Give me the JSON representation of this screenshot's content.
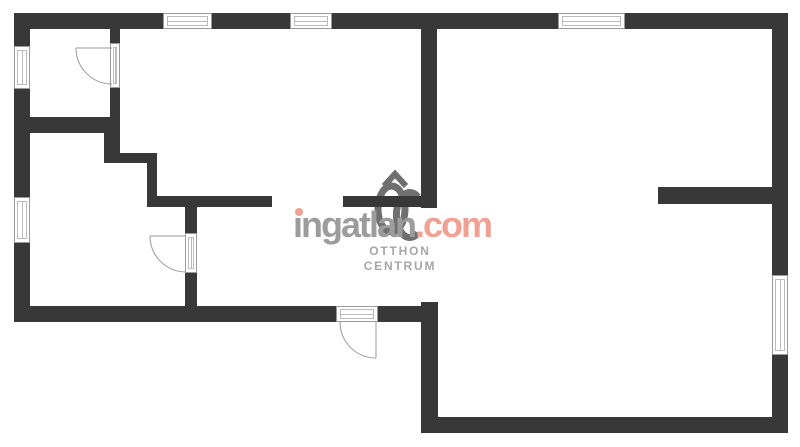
{
  "page": {
    "background": "#ffffff"
  },
  "watermark": {
    "brand": {
      "first_letter": "i",
      "rest": "ngatlan",
      "tld": ".com"
    },
    "logo_text_line1": "OTTHON",
    "logo_text_line2": "CENTRUM",
    "colors": {
      "brand_gray": "#9c9c9c",
      "accent_salmon": "#f0a292",
      "logo_gray": "#6f6f6f",
      "logo_text_gray": "#a6a6a6"
    }
  },
  "floorplan": {
    "canvas": {
      "width": 800,
      "height": 447
    },
    "wall_color": "#383838",
    "symbol_stroke": "#9a9a9a",
    "walls": [
      {
        "name": "wall-exterior-top",
        "x": 14,
        "y": 13,
        "w": 774,
        "h": 16
      },
      {
        "name": "wall-exterior-left",
        "x": 14,
        "y": 13,
        "w": 16,
        "h": 309
      },
      {
        "name": "wall-exterior-right",
        "x": 772,
        "y": 13,
        "w": 16,
        "h": 420
      },
      {
        "name": "wall-bottom-left-section",
        "x": 14,
        "y": 306,
        "w": 424,
        "h": 16
      },
      {
        "name": "wall-bottom-right-section",
        "x": 421,
        "y": 417,
        "w": 367,
        "h": 16
      },
      {
        "name": "wall-central-upper",
        "x": 421,
        "y": 29,
        "w": 16,
        "h": 179
      },
      {
        "name": "wall-central-lower",
        "x": 421,
        "y": 302,
        "w": 17,
        "h": 131
      },
      {
        "name": "wall-room1-right",
        "x": 110,
        "y": 29,
        "w": 10,
        "h": 104
      },
      {
        "name": "wall-room1-bottom",
        "x": 14,
        "y": 117,
        "w": 106,
        "h": 16
      },
      {
        "name": "wall-step-vertical-1",
        "x": 104,
        "y": 133,
        "w": 16,
        "h": 30
      },
      {
        "name": "wall-step-horizontal",
        "x": 104,
        "y": 153,
        "w": 53,
        "h": 10
      },
      {
        "name": "wall-step-vertical-2",
        "x": 147,
        "y": 153,
        "w": 10,
        "h": 54
      },
      {
        "name": "wall-hall-top-left",
        "x": 147,
        "y": 196,
        "w": 125,
        "h": 11
      },
      {
        "name": "wall-hall-top-right",
        "x": 343,
        "y": 196,
        "w": 94,
        "h": 11
      },
      {
        "name": "wall-hall-left",
        "x": 185,
        "y": 207,
        "w": 12,
        "h": 99
      },
      {
        "name": "wall-right-room-stub",
        "x": 658,
        "y": 187,
        "w": 130,
        "h": 17
      }
    ],
    "windows": [
      {
        "name": "window-top-1",
        "x": 163,
        "y": 13,
        "w": 49,
        "h": 16,
        "orientation": "h"
      },
      {
        "name": "window-top-2",
        "x": 290,
        "y": 13,
        "w": 42,
        "h": 16,
        "orientation": "h"
      },
      {
        "name": "window-top-3",
        "x": 558,
        "y": 13,
        "w": 67,
        "h": 16,
        "orientation": "h"
      },
      {
        "name": "window-left-1",
        "x": 14,
        "y": 46,
        "w": 16,
        "h": 43,
        "orientation": "v"
      },
      {
        "name": "window-left-2",
        "x": 14,
        "y": 197,
        "w": 16,
        "h": 46,
        "orientation": "v"
      },
      {
        "name": "window-right-1",
        "x": 772,
        "y": 275,
        "w": 16,
        "h": 80,
        "orientation": "v"
      }
    ],
    "door_frames": [
      {
        "name": "door-frame-room1",
        "x": 110,
        "y": 43,
        "w": 10,
        "h": 45,
        "orientation": "v"
      },
      {
        "name": "door-frame-room2",
        "x": 185,
        "y": 233,
        "w": 12,
        "h": 40,
        "orientation": "v"
      },
      {
        "name": "door-frame-entry",
        "x": 336,
        "y": 306,
        "w": 42,
        "h": 16,
        "orientation": "h"
      }
    ],
    "door_arcs": [
      {
        "name": "door-swing-room1",
        "arc": "M 76 48 A 36 36 0 0 0 112 84",
        "leaf": "M 76 48 L 112 48"
      },
      {
        "name": "door-swing-room2",
        "arc": "M 150 236 A 36 36 0 0 0 186 272",
        "leaf": "M 150 236 L 186 236"
      },
      {
        "name": "door-swing-entry",
        "arc": "M 340 322 A 36 36 0 0 0 376 358",
        "leaf": "M 376 322 L 376 358"
      }
    ]
  }
}
